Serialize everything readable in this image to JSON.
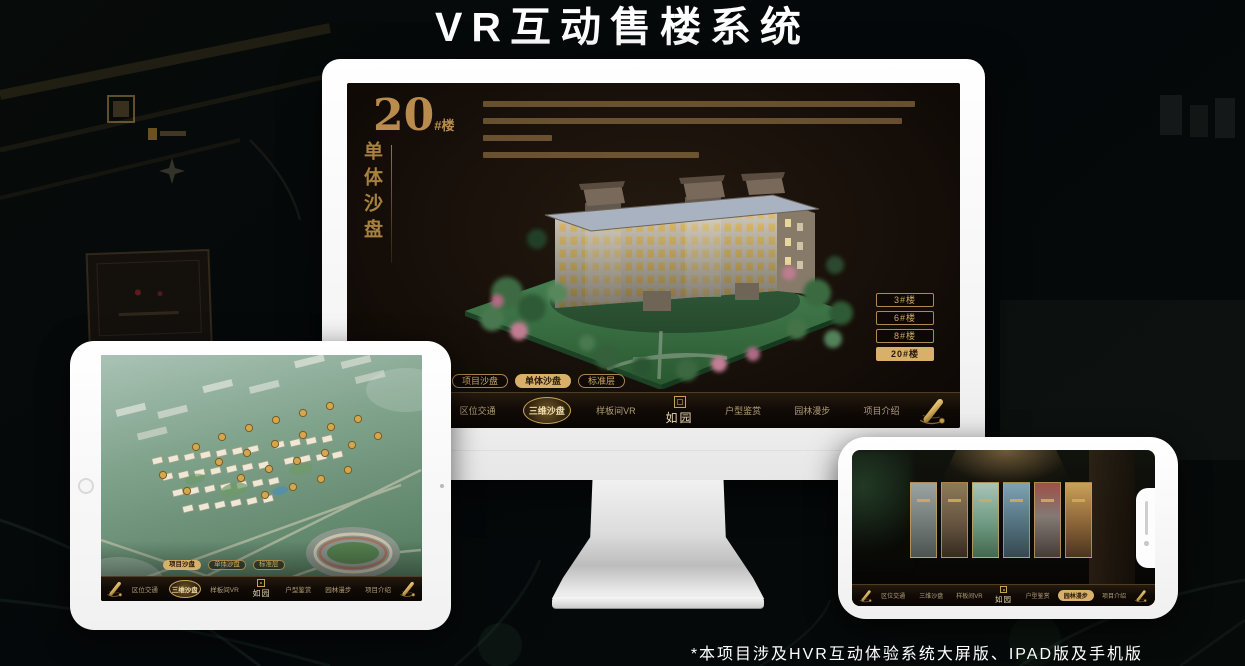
{
  "page": {
    "title": "VR互动售楼系统",
    "footnote": "*本项目涉及HVR互动体验系统大屏版、IPAD版及手机版"
  },
  "colors": {
    "gold": "#c9a35b",
    "gold_bright": "#d9b06a",
    "hero_gold": "#b98c4e",
    "screen_dark": "#170f09",
    "device_white": "#fdfdfd"
  },
  "desktop": {
    "hero": {
      "number": "20",
      "suffix": "#楼",
      "subtitle": "单体沙盘"
    },
    "floor_buttons": [
      {
        "label": "3#楼",
        "active": false
      },
      {
        "label": "6#楼",
        "active": false
      },
      {
        "label": "8#楼",
        "active": false
      },
      {
        "label": "20#楼",
        "active": true
      }
    ],
    "sub_tabs": [
      {
        "label": "项目沙盘",
        "active": false
      },
      {
        "label": "单体沙盘",
        "active": true
      },
      {
        "label": "标准层",
        "active": false
      }
    ],
    "nav": {
      "logo": "如园",
      "items": [
        {
          "label": "区位交通",
          "active": false
        },
        {
          "label": "三维沙盘",
          "active": true
        },
        {
          "label": "样板间VR",
          "active": false
        },
        {
          "label": "户型鉴赏",
          "active": false
        },
        {
          "label": "园林漫步",
          "active": false
        },
        {
          "label": "项目介绍",
          "active": false
        }
      ]
    }
  },
  "tablet": {
    "sub_tabs": [
      {
        "label": "项目沙盘",
        "active": true
      },
      {
        "label": "单体沙盘",
        "active": false
      },
      {
        "label": "标准层",
        "active": false
      }
    ],
    "nav": {
      "logo": "如园",
      "items": [
        {
          "label": "区位交通",
          "active": false
        },
        {
          "label": "三维沙盘",
          "active": true
        },
        {
          "label": "样板间VR",
          "active": false
        },
        {
          "label": "户型鉴赏",
          "active": false
        },
        {
          "label": "园林漫步",
          "active": false
        },
        {
          "label": "项目介绍",
          "active": false
        }
      ]
    }
  },
  "phone": {
    "nav": {
      "logo": "如园",
      "items": [
        {
          "label": "区位交通",
          "active": false
        },
        {
          "label": "三维沙盘",
          "active": false
        },
        {
          "label": "样板间VR",
          "active": false
        },
        {
          "label": "户型鉴赏",
          "active": false
        },
        {
          "label": "园林漫步",
          "active": true
        },
        {
          "label": "项目介绍",
          "active": false
        }
      ]
    },
    "gallery_card_count": "6"
  }
}
